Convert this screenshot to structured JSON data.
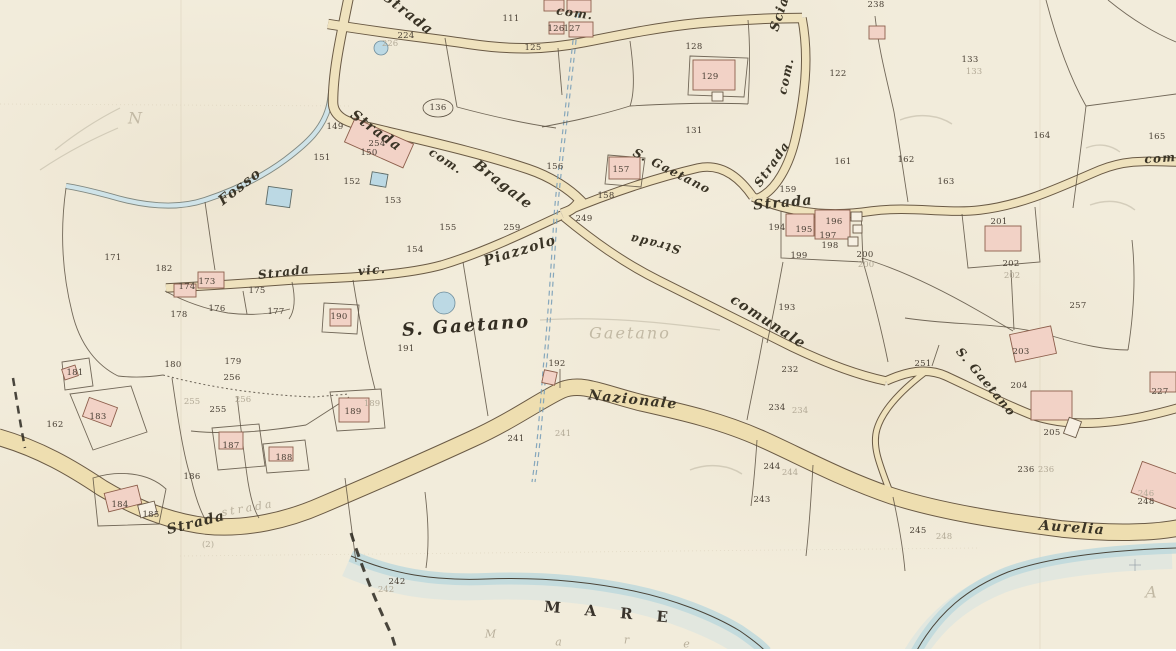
{
  "meta": {
    "description": "Historical Italian cadastral map sheet (scanned), locality S. Gaetano on the coast (MARE), crossed by Strada Nazionale Aurelia",
    "sea_label": "MARE"
  },
  "colors": {
    "paper": "#f2ecdb",
    "road_fill": "#efe2bd",
    "road_casing": "#6a5a45",
    "building_fill": "#f2d2c6",
    "building_stroke": "#8d5f4c",
    "water": "#bcd8dc",
    "ink": "#4a4136",
    "label_ink": "#3a3426",
    "pencil": "#b3aa97"
  },
  "road_labels": [
    {
      "t": "Strada",
      "x": 408,
      "y": 14,
      "r": 38
    },
    {
      "t": "com.",
      "x": 575,
      "y": 13,
      "r": 8,
      "s": 12
    },
    {
      "t": "Scia",
      "x": 780,
      "y": 14,
      "r": -72,
      "s": 13
    },
    {
      "t": "com.",
      "x": 786,
      "y": 76,
      "r": -78,
      "s": 12
    },
    {
      "t": "Strada",
      "x": 376,
      "y": 131,
      "r": 36
    },
    {
      "t": "com.",
      "x": 446,
      "y": 161,
      "r": 33,
      "s": 12
    },
    {
      "t": "Bragale",
      "x": 503,
      "y": 185,
      "r": 38
    },
    {
      "t": "S. Gaetano",
      "x": 672,
      "y": 171,
      "r": 27,
      "s": 12
    },
    {
      "t": "Strada",
      "x": 772,
      "y": 164,
      "r": -55,
      "s": 12
    },
    {
      "t": "Strada",
      "x": 783,
      "y": 203,
      "r": -5
    },
    {
      "t": "Fosso",
      "x": 240,
      "y": 187,
      "r": -38
    },
    {
      "t": "Strada",
      "x": 284,
      "y": 272,
      "r": -7,
      "s": 12
    },
    {
      "t": "vic.",
      "x": 372,
      "y": 270,
      "r": -5,
      "s": 12
    },
    {
      "t": "Piazzolo",
      "x": 520,
      "y": 251,
      "r": -17
    },
    {
      "t": "Strada",
      "x": 655,
      "y": 244,
      "r": 193,
      "s": 12
    },
    {
      "t": "comunale",
      "x": 768,
      "y": 322,
      "r": 33
    },
    {
      "t": "S. Gaetano",
      "x": 466,
      "y": 326,
      "r": -4,
      "c": "cursive-big"
    },
    {
      "t": "Nazionale",
      "x": 633,
      "y": 400,
      "r": 6
    },
    {
      "t": "S. Gaetano",
      "x": 986,
      "y": 382,
      "r": 50,
      "s": 12
    },
    {
      "t": "Aurelia",
      "x": 1072,
      "y": 528,
      "r": 4
    },
    {
      "t": "Strada",
      "x": 196,
      "y": 523,
      "r": -14
    },
    {
      "t": "com.",
      "x": 1163,
      "y": 158,
      "r": -4,
      "s": 12
    },
    {
      "t": "MARE",
      "x": 618,
      "y": 613,
      "r": 5,
      "c": "mare"
    }
  ],
  "parcel_numbers": [
    {
      "t": "111",
      "x": 511,
      "y": 19
    },
    {
      "t": "224",
      "x": 406,
      "y": 36
    },
    {
      "t": "125",
      "x": 533,
      "y": 48
    },
    {
      "t": "126",
      "x": 556,
      "y": 29
    },
    {
      "t": "127",
      "x": 572,
      "y": 29
    },
    {
      "t": "128",
      "x": 694,
      "y": 47
    },
    {
      "t": "129",
      "x": 710,
      "y": 77
    },
    {
      "t": "131",
      "x": 694,
      "y": 131
    },
    {
      "t": "122",
      "x": 838,
      "y": 74
    },
    {
      "t": "133",
      "x": 970,
      "y": 60
    },
    {
      "t": "238",
      "x": 876,
      "y": 5
    },
    {
      "t": "136",
      "x": 438,
      "y": 108
    },
    {
      "t": "149",
      "x": 335,
      "y": 127
    },
    {
      "t": "254",
      "x": 377,
      "y": 144
    },
    {
      "t": "150",
      "x": 369,
      "y": 153
    },
    {
      "t": "151",
      "x": 322,
      "y": 158
    },
    {
      "t": "152",
      "x": 352,
      "y": 182
    },
    {
      "t": "153",
      "x": 393,
      "y": 201
    },
    {
      "t": "156",
      "x": 555,
      "y": 167
    },
    {
      "t": "157",
      "x": 621,
      "y": 170
    },
    {
      "t": "158",
      "x": 606,
      "y": 196
    },
    {
      "t": "249",
      "x": 584,
      "y": 219
    },
    {
      "t": "259",
      "x": 512,
      "y": 228
    },
    {
      "t": "155",
      "x": 448,
      "y": 228
    },
    {
      "t": "154",
      "x": 415,
      "y": 250
    },
    {
      "t": "159",
      "x": 788,
      "y": 190
    },
    {
      "t": "161",
      "x": 843,
      "y": 162
    },
    {
      "t": "162",
      "x": 906,
      "y": 160
    },
    {
      "t": "163",
      "x": 946,
      "y": 182
    },
    {
      "t": "164",
      "x": 1042,
      "y": 136
    },
    {
      "t": "165",
      "x": 1157,
      "y": 137
    },
    {
      "t": "194",
      "x": 777,
      "y": 228
    },
    {
      "t": "195",
      "x": 804,
      "y": 230
    },
    {
      "t": "196",
      "x": 834,
      "y": 222
    },
    {
      "t": "197",
      "x": 828,
      "y": 236
    },
    {
      "t": "198",
      "x": 830,
      "y": 246
    },
    {
      "t": "199",
      "x": 799,
      "y": 256
    },
    {
      "t": "200",
      "x": 865,
      "y": 255
    },
    {
      "t": "193",
      "x": 787,
      "y": 308
    },
    {
      "t": "201",
      "x": 999,
      "y": 222
    },
    {
      "t": "202",
      "x": 1011,
      "y": 264
    },
    {
      "t": "257",
      "x": 1078,
      "y": 306
    },
    {
      "t": "171",
      "x": 113,
      "y": 258
    },
    {
      "t": "182",
      "x": 164,
      "y": 269
    },
    {
      "t": "173",
      "x": 207,
      "y": 282
    },
    {
      "t": "174",
      "x": 187,
      "y": 287
    },
    {
      "t": "175",
      "x": 257,
      "y": 291
    },
    {
      "t": "176",
      "x": 217,
      "y": 309
    },
    {
      "t": "178",
      "x": 179,
      "y": 315
    },
    {
      "t": "177",
      "x": 276,
      "y": 312
    },
    {
      "t": "190",
      "x": 339,
      "y": 317
    },
    {
      "t": "179",
      "x": 233,
      "y": 362
    },
    {
      "t": "180",
      "x": 173,
      "y": 365
    },
    {
      "t": "256",
      "x": 232,
      "y": 378
    },
    {
      "t": "255",
      "x": 218,
      "y": 410
    },
    {
      "t": "186",
      "x": 192,
      "y": 477
    },
    {
      "t": "187",
      "x": 231,
      "y": 446
    },
    {
      "t": "188",
      "x": 284,
      "y": 458
    },
    {
      "t": "183",
      "x": 98,
      "y": 417
    },
    {
      "t": "181",
      "x": 75,
      "y": 373
    },
    {
      "t": "162",
      "x": 55,
      "y": 425
    },
    {
      "t": "184",
      "x": 120,
      "y": 505
    },
    {
      "t": "185",
      "x": 151,
      "y": 515
    },
    {
      "t": "189",
      "x": 353,
      "y": 412
    },
    {
      "t": "191",
      "x": 406,
      "y": 349
    },
    {
      "t": "192",
      "x": 557,
      "y": 364
    },
    {
      "t": "241",
      "x": 516,
      "y": 439
    },
    {
      "t": "232",
      "x": 790,
      "y": 370
    },
    {
      "t": "234",
      "x": 777,
      "y": 408
    },
    {
      "t": "244",
      "x": 772,
      "y": 467
    },
    {
      "t": "243",
      "x": 762,
      "y": 500
    },
    {
      "t": "245",
      "x": 918,
      "y": 531
    },
    {
      "t": "251",
      "x": 923,
      "y": 364
    },
    {
      "t": "203",
      "x": 1021,
      "y": 352
    },
    {
      "t": "204",
      "x": 1019,
      "y": 386
    },
    {
      "t": "205",
      "x": 1052,
      "y": 433
    },
    {
      "t": "236",
      "x": 1026,
      "y": 470
    },
    {
      "t": "227",
      "x": 1160,
      "y": 392
    },
    {
      "t": "248",
      "x": 1146,
      "y": 502
    },
    {
      "t": "242",
      "x": 397,
      "y": 582
    }
  ],
  "pencil_annotations": [
    {
      "t": "226",
      "x": 390,
      "y": 44
    },
    {
      "t": "133",
      "x": 974,
      "y": 72
    },
    {
      "t": "200",
      "x": 866,
      "y": 265
    },
    {
      "t": "202",
      "x": 1012,
      "y": 276
    },
    {
      "t": "189",
      "x": 372,
      "y": 404
    },
    {
      "t": "241",
      "x": 563,
      "y": 434
    },
    {
      "t": "234",
      "x": 800,
      "y": 411
    },
    {
      "t": "244",
      "x": 790,
      "y": 473
    },
    {
      "t": "248",
      "x": 944,
      "y": 537
    },
    {
      "t": "236",
      "x": 1046,
      "y": 470
    },
    {
      "t": "246",
      "x": 1146,
      "y": 494
    },
    {
      "t": "242",
      "x": 386,
      "y": 590
    },
    {
      "t": "255",
      "x": 192,
      "y": 402
    },
    {
      "t": "256",
      "x": 243,
      "y": 400
    },
    {
      "t": "strada",
      "x": 248,
      "y": 508,
      "r": -10,
      "c": "pencil-script"
    },
    {
      "t": "Gaetano",
      "x": 630,
      "y": 333,
      "c": "pencil-big"
    },
    {
      "t": "N",
      "x": 136,
      "y": 118,
      "c": "pencil-big"
    },
    {
      "t": "A",
      "x": 1152,
      "y": 592,
      "c": "pencil-big"
    },
    {
      "t": "(2)",
      "x": 208,
      "y": 545
    },
    {
      "t": "M",
      "x": 492,
      "y": 634,
      "c": "pencil-script"
    },
    {
      "t": "a",
      "x": 560,
      "y": 642,
      "c": "pencil-script"
    },
    {
      "t": "r",
      "x": 628,
      "y": 640,
      "c": "pencil-script"
    },
    {
      "t": "e",
      "x": 688,
      "y": 644,
      "c": "pencil-script"
    }
  ],
  "buildings": [
    {
      "x": 544,
      "y": 0,
      "w": 20,
      "h": 11
    },
    {
      "x": 567,
      "y": 0,
      "w": 24,
      "h": 12
    },
    {
      "x": 549,
      "y": 22,
      "w": 15,
      "h": 12
    },
    {
      "x": 569,
      "y": 22,
      "w": 24,
      "h": 15
    },
    {
      "x": 693,
      "y": 60,
      "w": 42,
      "h": 30
    },
    {
      "x": 712,
      "y": 92,
      "w": 11,
      "h": 9,
      "f": "w"
    },
    {
      "x": 869,
      "y": 26,
      "w": 16,
      "h": 13
    },
    {
      "x": 347,
      "y": 130,
      "w": 64,
      "h": 26,
      "r": 24
    },
    {
      "x": 609,
      "y": 157,
      "w": 31,
      "h": 22
    },
    {
      "x": 198,
      "y": 272,
      "w": 26,
      "h": 16
    },
    {
      "x": 174,
      "y": 284,
      "w": 22,
      "h": 13
    },
    {
      "x": 330,
      "y": 309,
      "w": 21,
      "h": 17
    },
    {
      "x": 63,
      "y": 367,
      "w": 14,
      "h": 11,
      "r": -18
    },
    {
      "x": 85,
      "y": 402,
      "w": 30,
      "h": 20,
      "r": 20
    },
    {
      "x": 106,
      "y": 489,
      "w": 34,
      "h": 19,
      "r": -14
    },
    {
      "x": 139,
      "y": 503,
      "w": 17,
      "h": 13,
      "r": -14,
      "f": "w"
    },
    {
      "x": 219,
      "y": 432,
      "w": 24,
      "h": 17
    },
    {
      "x": 269,
      "y": 447,
      "w": 24,
      "h": 14
    },
    {
      "x": 339,
      "y": 398,
      "w": 30,
      "h": 24
    },
    {
      "x": 543,
      "y": 371,
      "w": 13,
      "h": 13,
      "r": 12
    },
    {
      "x": 786,
      "y": 214,
      "w": 28,
      "h": 22
    },
    {
      "x": 815,
      "y": 210,
      "w": 35,
      "h": 29
    },
    {
      "x": 851,
      "y": 212,
      "w": 11,
      "h": 9,
      "f": "w"
    },
    {
      "x": 853,
      "y": 225,
      "w": 9,
      "h": 8,
      "f": "w"
    },
    {
      "x": 848,
      "y": 237,
      "w": 10,
      "h": 9,
      "f": "w"
    },
    {
      "x": 985,
      "y": 226,
      "w": 36,
      "h": 25
    },
    {
      "x": 1012,
      "y": 330,
      "w": 42,
      "h": 28,
      "r": -12
    },
    {
      "x": 1031,
      "y": 391,
      "w": 41,
      "h": 29
    },
    {
      "x": 1066,
      "y": 419,
      "w": 13,
      "h": 17,
      "r": 20,
      "f": "w"
    },
    {
      "x": 1135,
      "y": 470,
      "w": 56,
      "h": 33,
      "r": 20
    },
    {
      "x": 1150,
      "y": 372,
      "w": 26,
      "h": 20
    },
    {
      "x": 371,
      "y": 173,
      "w": 16,
      "h": 13,
      "r": 10,
      "f": "b"
    },
    {
      "x": 267,
      "y": 188,
      "w": 24,
      "h": 18,
      "r": 8,
      "f": "b"
    }
  ]
}
